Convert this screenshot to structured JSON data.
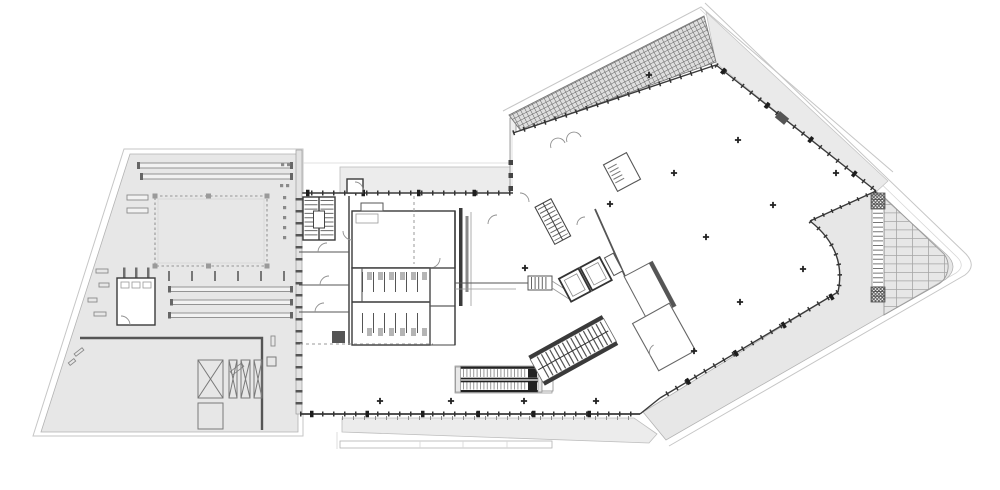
{
  "document": {
    "kind": "architectural-floor-plan",
    "style": "CAD line drawing, plan view, no text labels visible",
    "visible_text": []
  },
  "canvas": {
    "width": 1000,
    "height": 490,
    "background": "#ffffff"
  },
  "palette": {
    "paper": "#ffffff",
    "roof_fill": "#e7e7e7",
    "terrace_fill": "#ececec",
    "wall_dark": "#3a3a3a",
    "line_medium": "#777777",
    "line_light": "#c6c6c6",
    "hatch_line": "#666666",
    "rail_dark": "#222222"
  },
  "zones": [
    {
      "name": "west-wing-roof",
      "shape": "trapezoid",
      "features": [
        "skylight-dashed-opening",
        "roof-bars",
        "plant-room",
        "smoke-hatches-x-boxes"
      ]
    },
    {
      "name": "central-wing",
      "features": [
        "entrance-band",
        "stair-northwest",
        "restroom-core",
        "escalator-pair",
        "south-facade-mullions",
        "south-terrace-strip"
      ]
    },
    {
      "name": "east-hall",
      "rotation_deg": -27,
      "features": [
        "skylight-grid-band",
        "mullion-facades",
        "column-grid-marks",
        "curved-southeast-corner"
      ]
    },
    {
      "name": "east-terrace",
      "features": [
        "paving-grid-rounded-corner",
        "service-stair-strip"
      ]
    },
    {
      "name": "core-between-wings",
      "features": [
        "rotated-stairs",
        "elevator-shafts",
        "rotated-rooms"
      ]
    }
  ],
  "symbols": {
    "column_mark_count": 15,
    "escalator_lanes": 2,
    "x_hatch_boxes": 4,
    "roof_bars_west_wing": 5
  }
}
